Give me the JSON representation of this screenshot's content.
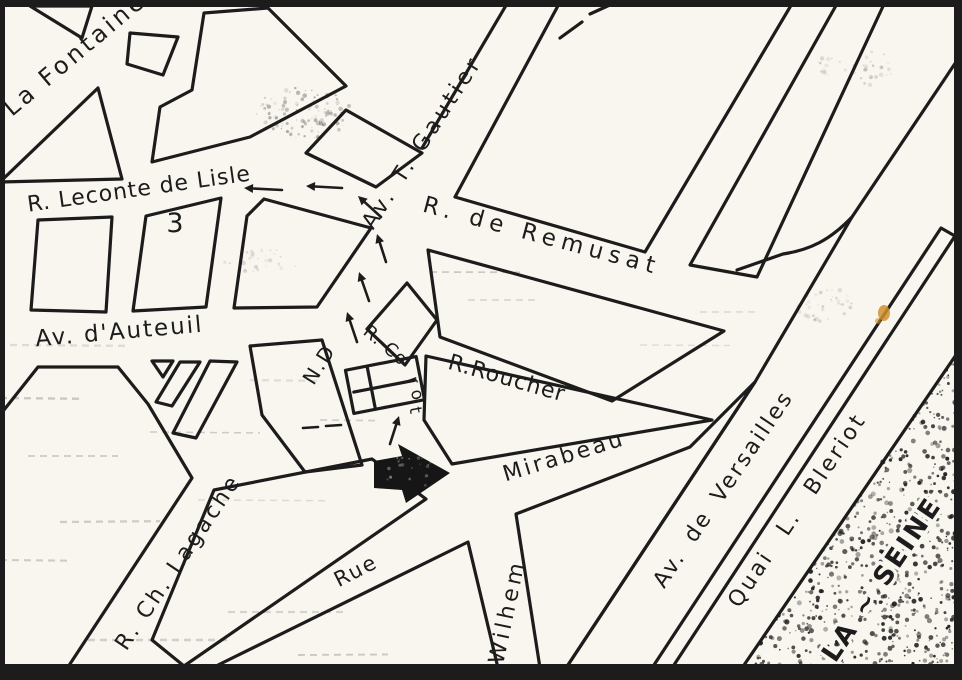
{
  "map_type": "scanned hand-drawn street map (Auteuil district, Paris)",
  "colors": {
    "ink": "#1c1c1c",
    "paper": "#f9f6ef",
    "stain": "#cf8f2e",
    "smudge": "#555555"
  },
  "labels": {
    "la_fontaine": "La Fontaine",
    "leconte_de_lisle": "R. Leconte de Lisle",
    "block_number": "3",
    "t_gautier": "Av. T. Gautier",
    "remusat": "R. de Remusat",
    "auteuil": "Av. d'Auteuil",
    "notre_dame": "N.D",
    "corot_main": "R. Co",
    "corot_r": "r",
    "corot_o": "o",
    "corot_t": "t",
    "roucher": "R.Roucher",
    "mirabeau": "Mirabeau",
    "rue": "Rue",
    "wilhem": "Wilhem",
    "lagache": "R. Ch. Lagache",
    "versailles": "Av. de Versailles",
    "quai_bleriot": "Quai L. Bleriot",
    "seine": "LA ~ SEINE"
  },
  "icons": {
    "church_cross": "latin-cross marker inside rectangle (church of Notre-Dame d'Auteuil)",
    "destination_arrow": "large solid black arrow pointing right at the church square",
    "route_arrow": "small dashed-route direction arrow",
    "market_stalls": "hatched stall strips along Av. d'Auteuil",
    "river_texture": "stippled band of the Seine river"
  }
}
